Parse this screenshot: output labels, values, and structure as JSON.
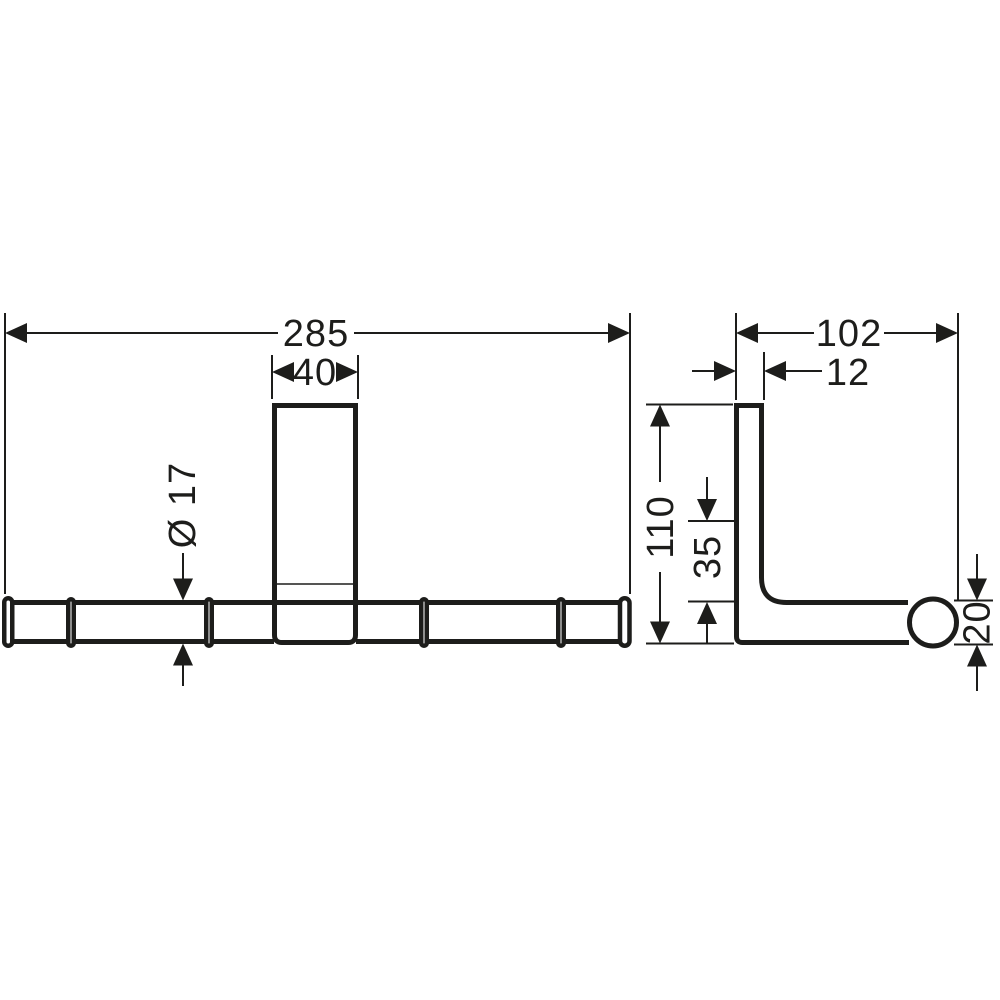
{
  "drawing": {
    "line_color": "#1d1d1b",
    "background_color": "#ffffff",
    "front_view": {
      "width": "285",
      "plate_width": "40",
      "bar_diameter": "Ø 17"
    },
    "side_view": {
      "depth": "102",
      "plate_thickness": "12",
      "height": "110",
      "hook_offset": "35",
      "end_cap_diameter": "20"
    }
  }
}
